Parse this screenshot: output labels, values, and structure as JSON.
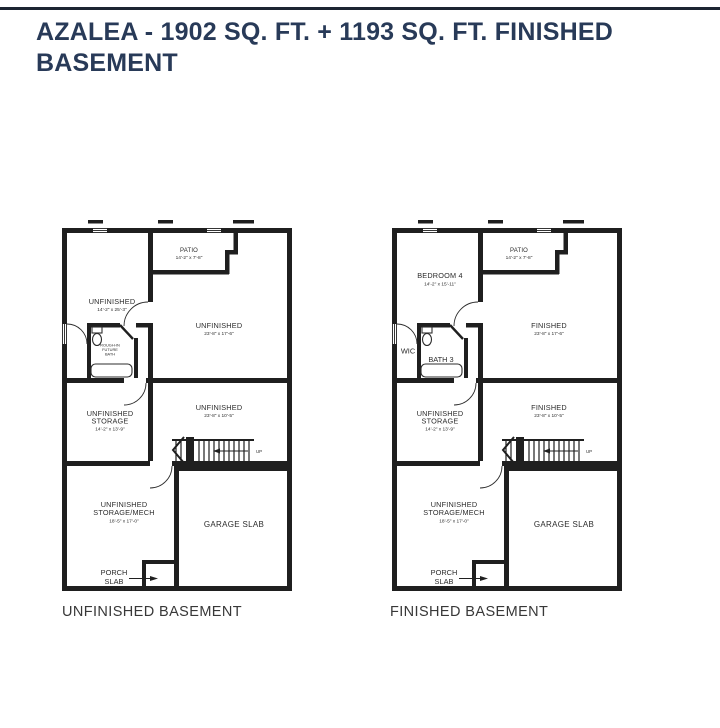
{
  "page": {
    "title": "AZALEA - 1902 SQ. FT. + 1193 SQ. FT. FINISHED BASEMENT"
  },
  "colors": {
    "title_navy": "#283a58",
    "wall_black": "#1f1f1f",
    "caption_gray": "#383838"
  },
  "plans": {
    "unfinished": {
      "caption": "UNFINISHED BASEMENT",
      "room1_name": "UNFINISHED",
      "room1_dims": "14'-2\" x 25'-3\"",
      "patio_name": "PATIO",
      "patio_dims": "14'-2\" x 7'-8\"",
      "main_name": "UNFINISHED",
      "main_dims": "23'-8\" x 17'-6\"",
      "bath_line1": "ROUGH-IN",
      "bath_line2": "FUTURE",
      "bath_line3": "BATH",
      "storage_name1": "UNFINISHED",
      "storage_name2": "STORAGE",
      "storage_dims": "14'-2\" x 13'-9\"",
      "hall_name": "UNFINISHED",
      "hall_dims": "23'-8\" x 10'-5\"",
      "mech_name1": "UNFINISHED",
      "mech_name2": "STORAGE/MECH",
      "mech_dims": "18'-5\" x 17'-0\"",
      "garage_name": "GARAGE SLAB",
      "porch_line1": "PORCH",
      "porch_line2": "SLAB",
      "up_label": "UP"
    },
    "finished": {
      "caption": "FINISHED BASEMENT",
      "room1_name": "BEDROOM 4",
      "room1_dims": "14'-2\" x 15'-11\"",
      "patio_name": "PATIO",
      "patio_dims": "14'-2\" x 7'-8\"",
      "main_name": "FINISHED",
      "main_dims": "23'-8\" x 17'-6\"",
      "wic_label": "WIC",
      "bath_label": "BATH 3",
      "storage_name1": "UNFINISHED",
      "storage_name2": "STORAGE",
      "storage_dims": "14'-2\" x 13'-9\"",
      "hall_name": "FINISHED",
      "hall_dims": "23'-8\" x 10'-5\"",
      "mech_name1": "UNFINISHED",
      "mech_name2": "STORAGE/MECH",
      "mech_dims": "18'-5\" x 17'-0\"",
      "garage_name": "GARAGE SLAB",
      "porch_line1": "PORCH",
      "porch_line2": "SLAB",
      "up_label": "UP"
    }
  }
}
